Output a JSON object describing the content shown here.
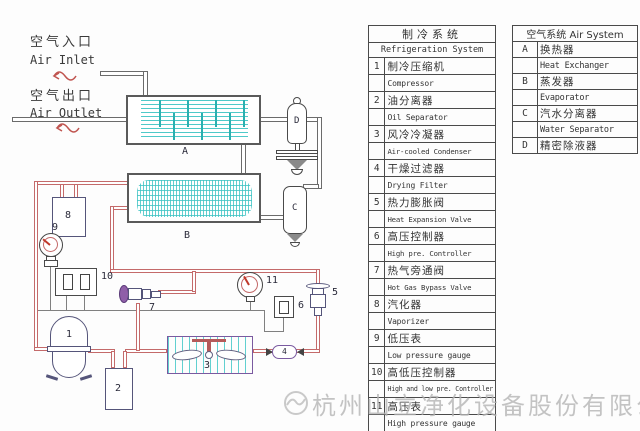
{
  "air_labels": {
    "inlet_cn": "空气入口",
    "inlet_en": "Air Inlet",
    "outlet_cn": "空气出口",
    "outlet_en": "Air Outlet"
  },
  "diagram_labels": {
    "A": "A",
    "B": "B",
    "C": "C",
    "D": "D",
    "n1": "1",
    "n2": "2",
    "n3": "3",
    "n4": "4",
    "n5": "5",
    "n6": "6",
    "n7": "7",
    "n8": "8",
    "n9": "9",
    "n10": "10",
    "n11": "11"
  },
  "refrigeration_table": {
    "title_cn": "制冷系统",
    "title_en": "Refrigeration System",
    "rows": [
      {
        "no": "1",
        "cn": "制冷压缩机",
        "en": "Compressor"
      },
      {
        "no": "2",
        "cn": "油分离器",
        "en": "Oil Separator"
      },
      {
        "no": "3",
        "cn": "风冷冷凝器",
        "en": "Air-cooled Condenser"
      },
      {
        "no": "4",
        "cn": "干燥过滤器",
        "en": "Drying Filter"
      },
      {
        "no": "5",
        "cn": "热力膨胀阀",
        "en": "Heat Expansion Valve"
      },
      {
        "no": "6",
        "cn": "高压控制器",
        "en": "High pre. Controller"
      },
      {
        "no": "7",
        "cn": "热气旁通阀",
        "en": "Hot Gas Bypass Valve"
      },
      {
        "no": "8",
        "cn": "汽化器",
        "en": "Vaporizer"
      },
      {
        "no": "9",
        "cn": "低压表",
        "en": "Low pressure gauge"
      },
      {
        "no": "10",
        "cn": "高低压控制器",
        "en": "High and low pre. Controller"
      },
      {
        "no": "11",
        "cn": "高压表",
        "en": "High pressure gauge"
      }
    ]
  },
  "air_table": {
    "title": "空气系统 Air System",
    "rows": [
      {
        "no": "A",
        "cn": "换热器",
        "en": "Heat Exchanger"
      },
      {
        "no": "B",
        "cn": "蒸发器",
        "en": "Evaporator"
      },
      {
        "no": "C",
        "cn": "汽水分离器",
        "en": "Water Separator"
      },
      {
        "no": "D",
        "cn": "精密除液器"
      }
    ]
  },
  "watermark": {
    "company": "杭州山立净化设备股份有限公司"
  },
  "colors": {
    "air_pipe": "#6b6b6b",
    "refrigerant_pipe": "#c46a6a",
    "exchanger_fill": "#3cc3c3",
    "accent_purple": "#7a5aa0",
    "needle_red": "#c0392b",
    "watermark_gray": "#b5b5b5"
  }
}
